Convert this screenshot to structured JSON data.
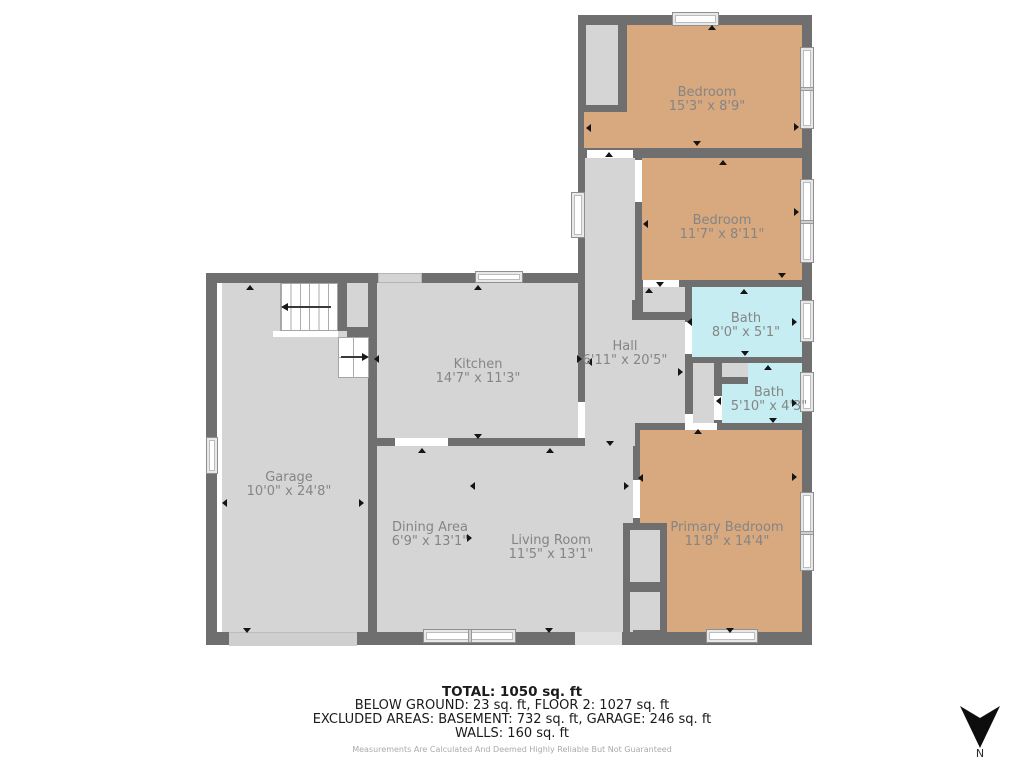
{
  "rooms": {
    "bedroom1": {
      "name": "Bedroom",
      "dims": "15'3\" x 8'9\""
    },
    "bedroom2": {
      "name": "Bedroom",
      "dims": "11'7\" x 8'11\""
    },
    "bath1": {
      "name": "Bath",
      "dims": "8'0\" x 5'1\""
    },
    "bath2": {
      "name": "Bath",
      "dims": "5'10\" x 4'3\""
    },
    "hall": {
      "name": "Hall",
      "dims": "6'11\" x 20'5\""
    },
    "kitchen": {
      "name": "Kitchen",
      "dims": "14'7\" x 11'3\""
    },
    "garage": {
      "name": "Garage",
      "dims": "10'0\" x 24'8\""
    },
    "dining": {
      "name": "Dining Area",
      "dims": "6'9\" x 13'1\""
    },
    "living": {
      "name": "Living Room",
      "dims": "11'5\" x 13'1\""
    },
    "primary": {
      "name": "Primary Bedroom",
      "dims": "11'8\" x 14'4\""
    }
  },
  "summary": {
    "total": "TOTAL: 1050 sq. ft",
    "line2": "BELOW GROUND: 23 sq. ft, FLOOR 2: 1027 sq. ft",
    "line3": "EXCLUDED AREAS: BASEMENT: 732 sq. ft, GARAGE: 246 sq. ft",
    "line4": "WALLS: 160 sq. ft",
    "disclaimer": "Measurements Are Calculated And Deemed Highly Reliable But Not Guaranteed"
  },
  "compass": {
    "label": "N"
  },
  "colors": {
    "wall": "#6f6f6f",
    "floor_gray": "#d5d5d5",
    "bedroom_tan": "#d8a87e",
    "bath_cyan": "#c6edf2"
  }
}
